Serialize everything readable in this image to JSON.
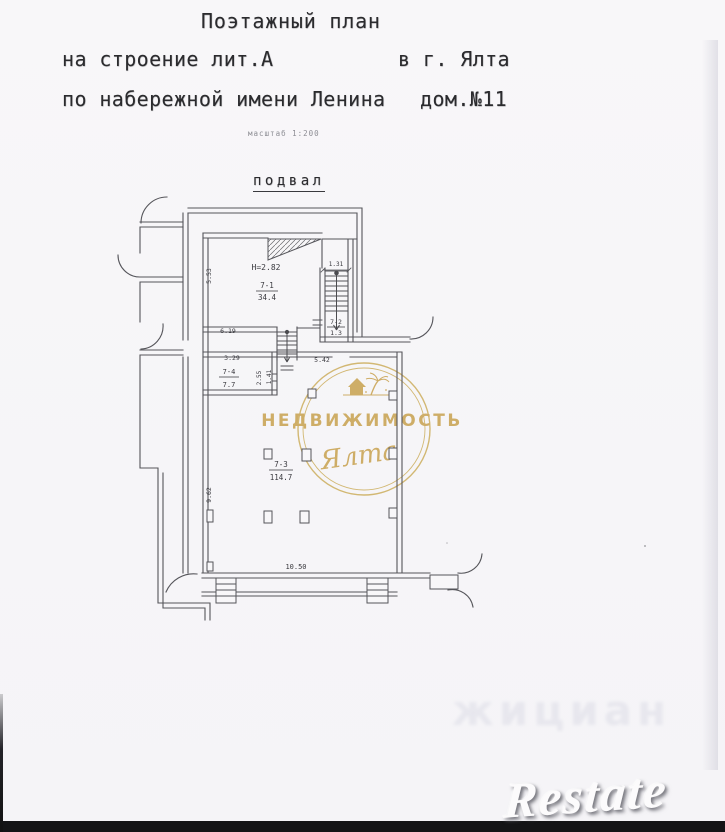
{
  "document": {
    "title": "Поэтажный план",
    "building": "на строение лит.А",
    "city": "в г. Ялта",
    "address": "по набережной имени Ленина",
    "house": "дом.№11",
    "scale_note": "масштаб 1:200",
    "floor_label": "подвал"
  },
  "plan": {
    "height_note": "Н=2.82",
    "rooms": {
      "r71": {
        "num": "7-1",
        "area": "34.4"
      },
      "r72": {
        "num": "7-2",
        "area": "1.3"
      },
      "r73": {
        "num": "7-3",
        "area": "114.7"
      },
      "r74": {
        "num": "7-4",
        "area": "7.7"
      }
    },
    "dims": {
      "left_top": "5.53",
      "stair_width": "1.31",
      "room71_bottom": "6.19",
      "room74_top": "3.29",
      "room74_right": "2.55",
      "room74_door": "1.41",
      "room73_top": "5.42",
      "room73_left": "9.62",
      "room73_bottom": "10.50"
    }
  },
  "watermark": {
    "brand": "НЕДВИЖИМОСТЬ",
    "city_script": "Ялта",
    "gold": "#c49a3f"
  },
  "artifacts": {
    "restate": "Restate",
    "bleed_through": "жициан"
  }
}
